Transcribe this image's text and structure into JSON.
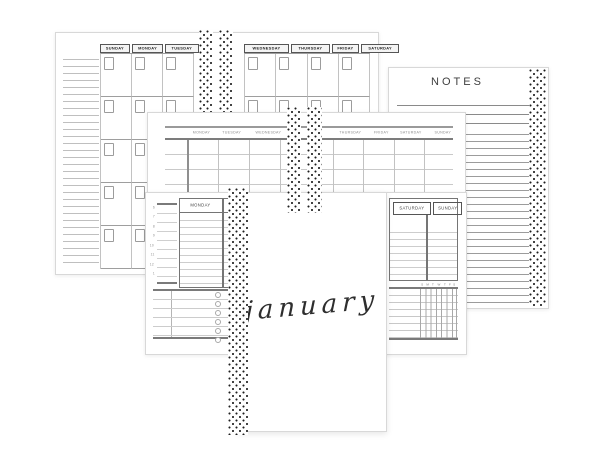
{
  "colors": {
    "page_bg": "#ffffff",
    "page_border": "#d8d8d8",
    "dot": "#1f1f1f",
    "thick_line": "#757575",
    "grid_dark": "#9e9e9e",
    "grid_light": "#c6c6c6",
    "text_dark": "#2e2e2e",
    "text_gray": "#8a8a8a"
  },
  "monthly_left": {
    "day_headers": [
      "SUNDAY",
      "MONDAY",
      "TUESDAY"
    ],
    "rows": 5,
    "cols": 3
  },
  "monthly_right": {
    "day_headers": [
      "WEDNESDAY",
      "THURSDAY",
      "FRIDAY",
      "SATURDAY"
    ],
    "rows": 5,
    "cols": 4
  },
  "notes": {
    "title": "NOTES"
  },
  "weekly": {
    "day_headers_left": [
      "MONDAY",
      "TUESDAY",
      "WEDNESDAY"
    ],
    "day_headers_right": [
      "THURSDAY",
      "FRIDAY",
      "SATURDAY",
      "SUNDAY"
    ]
  },
  "daily": {
    "left_day_headers": [
      "MONDAY",
      "TUESDAY"
    ],
    "right_day_headers": [
      "SATURDAY",
      "SUNDAY"
    ],
    "hour_labels": [
      "6",
      "7",
      "8",
      "9",
      "10",
      "11",
      "12",
      "1"
    ],
    "tracker_ticks": [
      "S",
      "M",
      "T",
      "W",
      "T",
      "F",
      "S"
    ],
    "todo_rows": 6
  },
  "cover": {
    "month": "january"
  }
}
